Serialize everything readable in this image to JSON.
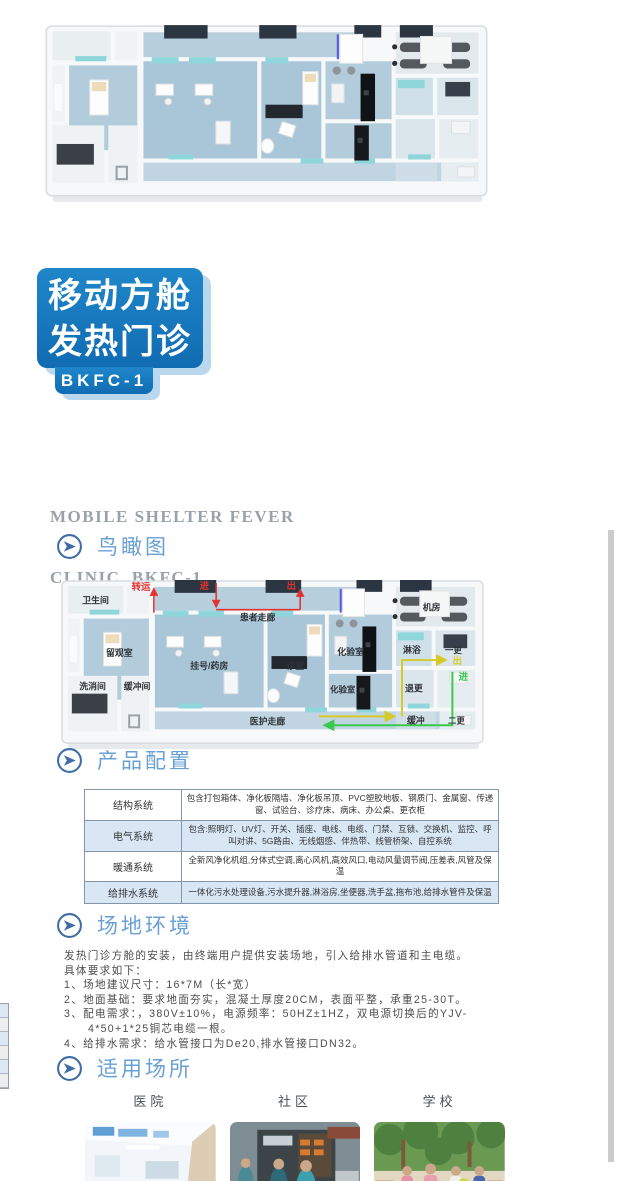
{
  "logo": {
    "line1": "移动方舱",
    "line2": "发热门诊",
    "model": "BKFC-1"
  },
  "subtitle": {
    "line1": "MOBILE SHELTER FEVER",
    "line2": "CLINIC  BKFC-1"
  },
  "sections": {
    "aerial": {
      "title": "鸟瞰图"
    },
    "config": {
      "title": "产品配置"
    },
    "site": {
      "title": "场地环境"
    },
    "places": {
      "title": "适用场所"
    }
  },
  "config_table": {
    "rows": [
      {
        "label": "结构系统",
        "value": "包含打包箱体、净化板隔墙、净化板吊顶、PVC塑胶地板、钢质门、金属窗、传递窗、试验台、诊疗床、病床、办公桌、更衣柜"
      },
      {
        "label": "电气系统",
        "value": "包含:照明灯、UV灯、开关、插座、电线、电缆、门禁、互锁、交换机、监控、呼叫对讲、5G路由、无线烟感、伴热带、线管桥架、自控系统"
      },
      {
        "label": "暖通系统",
        "value": "全新风净化机组,分体式空调,离心风机,高效风口,电动风量调节阀,压差表,风管及保温"
      },
      {
        "label": "给排水系统",
        "value": "一体化污水处理设备,污水提升器,淋浴房,坐便器,洗手盆,拖布池,给排水管件及保温"
      }
    ]
  },
  "site_text": {
    "lines": [
      "发热门诊方舱的安装，由终端用户提供安装场地，引入给排水管道和主电缆。",
      "具体要求如下：",
      "1、场地建议尺寸：16*7M（长*宽）",
      "2、地面基础：要求地面夯实，混凝土厚度20CM，表面平整，承重25-30T。",
      "3、配电需求：，380V±10%，电源频率：50HZ±1HZ，双电源切换后的YJV-",
      "4*50+1*25铜芯电缆一根。",
      "4、给排水需求：给水管接口为De20,排水管接口DN32。"
    ]
  },
  "places": [
    {
      "label": "医院"
    },
    {
      "label": "社区"
    },
    {
      "label": "学校"
    }
  ],
  "floorplan": {
    "rooms": [
      "卫生间",
      "留观室",
      "洗消间",
      "缓冲间",
      "挂号/药房",
      "诊室",
      "患者走廊",
      "医护走廊",
      "化验室",
      "化验室",
      "机房",
      "淋浴",
      "一更",
      "退更",
      "缓冲",
      "二更"
    ],
    "flows": {
      "transfer": "转运",
      "in_red": "进",
      "out_red": "出",
      "out_yellow": "出",
      "in_green": "进"
    }
  },
  "colors": {
    "brand_blue": "#1a7cc1",
    "logo_shadow": "#b9d8ee",
    "section_title_blue": "#69a0d4",
    "table_alt_row": "#d9e7f5",
    "flow_red": "#e23232",
    "flow_yellow": "#d6ca28",
    "flow_green": "#38c94e"
  }
}
